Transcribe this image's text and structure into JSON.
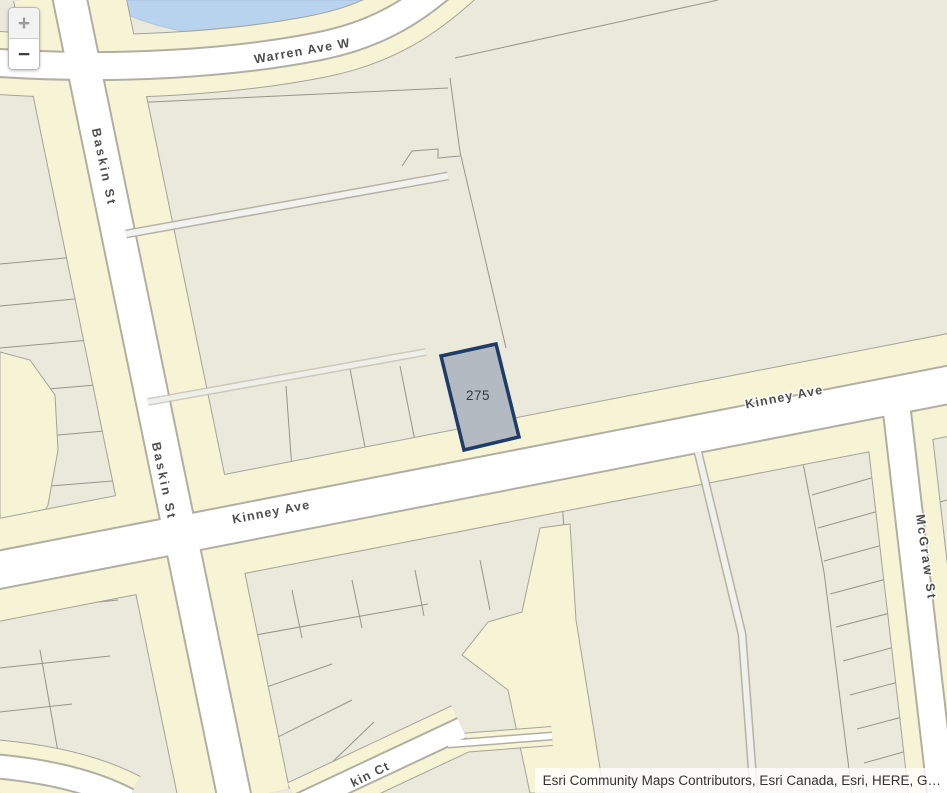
{
  "map": {
    "controls": {
      "zoom_in_label": "+",
      "zoom_out_label": "−"
    },
    "street_labels": {
      "warren_ave": "Warren Ave W",
      "baskin_st_north": "Baskin St",
      "baskin_st_south": "Baskin St",
      "kinney_ave_west": "Kinney Ave",
      "kinney_ave_east": "Kinney Ave",
      "mcgraw_st": "McGraw St",
      "kinney_ct_partial": "kin Ct"
    },
    "selected_parcel": {
      "id_label": "275",
      "fill": "#b4bac1",
      "outline": "#1e3c66"
    },
    "colors": {
      "water": "#b7d3ed",
      "parcel_base": "#eae9dc",
      "road_buffer": "#f7f4d6",
      "road_fill": "#ffffff",
      "road_casing": "#b1afa2",
      "parcel_line": "#96958a",
      "street_label": "#4e4e4e"
    },
    "attribution": {
      "text": "Esri Community Maps Contributors, Esri Canada, Esri, HERE, G…"
    }
  }
}
